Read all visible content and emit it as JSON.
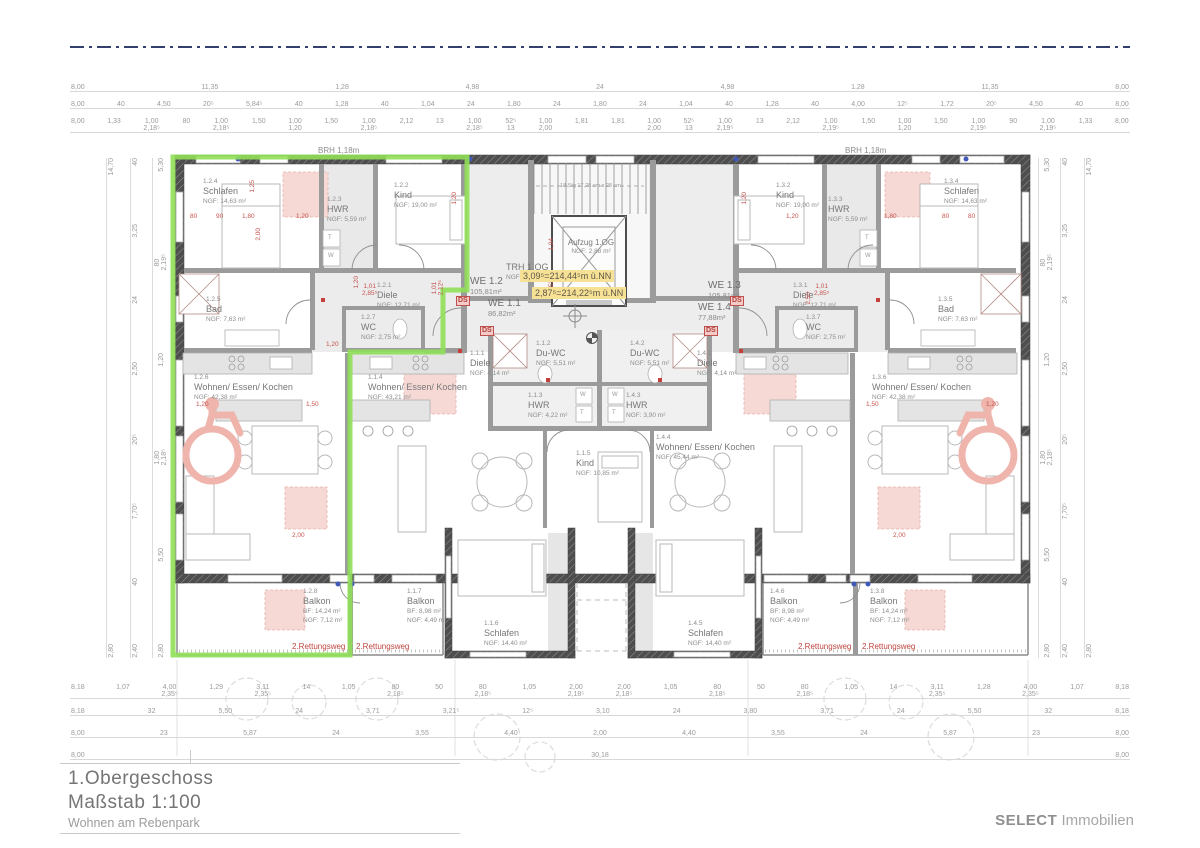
{
  "title_block": {
    "floor": "1.Obergeschoss",
    "scale": "Maßstab 1:100",
    "project": "Wohnen am Rebenpark"
  },
  "branding": {
    "company": "SELECT",
    "suffix": " Immobilien"
  },
  "core": {
    "trh_name": "TRH 1.OG",
    "trh_area": "NGF: 19,63 m²",
    "lift_name": "Aufzug 1.OG",
    "lift_area": "NGF: 2,88 m²",
    "stair_note": "18 Stg 17,28 cm x 28 cm",
    "elev_upper": "3,09⁵=214,44⁵m ü.NN",
    "elev_lower": "2,87⁵=214,22⁵m ü.NN"
  },
  "labels": {
    "brh": "BRH 1,18m",
    "ds": "DS",
    "escape": "2.Rettungsweg",
    "w": "W",
    "t": "T"
  },
  "units": {
    "we11": {
      "label": "WE 1.1",
      "area": "86,82m²"
    },
    "we12": {
      "label": "WE 1.2",
      "area": "105,81m²"
    },
    "we13": {
      "label": "WE 1.3",
      "area": "105,81m²"
    },
    "we14": {
      "label": "WE 1.4",
      "area": "77,88m²"
    }
  },
  "rooms": {
    "r124": {
      "id": "1.2.4",
      "name": "Schlafen",
      "area": "NGF: 14,63 m²"
    },
    "r123": {
      "id": "1.2.3",
      "name": "HWR",
      "area": "NGF: 5,59 m²"
    },
    "r122": {
      "id": "1.2.2",
      "name": "Kind",
      "area": "NGF: 19,00 m²"
    },
    "r121": {
      "id": "1.2.1",
      "name": "Diele",
      "area": "NGF: 12,71 m²"
    },
    "r125": {
      "id": "1.2.5",
      "name": "Bad",
      "area": "NGF: 7,63 m²"
    },
    "r127": {
      "id": "1.2.7",
      "name": "WC",
      "area": "NGF: 2,75 m²"
    },
    "r126": {
      "id": "1.2.6",
      "name": "Wohnen/ Essen/ Kochen",
      "area": "NGF: 42,38 m²"
    },
    "r128": {
      "id": "1.2.8",
      "name": "Balkon",
      "bf": "BF: 14,24 m²",
      "ngf": "NGF: 7,12 m²"
    },
    "r111": {
      "id": "1.1.1",
      "name": "Diele",
      "area": "NGF: 4,14 m²"
    },
    "r112": {
      "id": "1.1.2",
      "name": "Du-WC",
      "area": "NGF: 5,51 m²"
    },
    "r113": {
      "id": "1.1.3",
      "name": "HWR",
      "area": "NGF: 4,22 m²"
    },
    "r114": {
      "id": "1.1.4",
      "name": "Wohnen/ Essen/ Kochen",
      "area": "NGF: 43,21 m²"
    },
    "r115": {
      "id": "1.1.5",
      "name": "Kind",
      "area": "NGF: 10,85 m²"
    },
    "r116": {
      "id": "1.1.6",
      "name": "Schlafen",
      "area": "NGF: 14,40 m²"
    },
    "r117": {
      "id": "1.1.7",
      "name": "Balkon",
      "bf": "BF: 8,98 m²",
      "ngf": "NGF: 4,49 m²"
    },
    "r141": {
      "id": "1.4.1",
      "name": "Diele",
      "area": "NGF: 4,14 m²"
    },
    "r142": {
      "id": "1.4.2",
      "name": "Du-WC",
      "area": "NGF: 5,51 m²"
    },
    "r143": {
      "id": "1.4.3",
      "name": "HWR",
      "area": "NGF: 3,90 m²"
    },
    "r144": {
      "id": "1.4.4",
      "name": "Wohnen/ Essen/ Kochen",
      "area": "NGF: 45,44 m²"
    },
    "r145": {
      "id": "1.4.5",
      "name": "Schlafen",
      "area": "NGF: 14,40 m²"
    },
    "r146": {
      "id": "1.4.6",
      "name": "Balkon",
      "bf": "BF: 8,98 m²",
      "ngf": "NGF: 4,49 m²"
    },
    "r131": {
      "id": "1.3.1",
      "name": "Diele",
      "area": "NGF: 12,71 m²"
    },
    "r132": {
      "id": "1.3.2",
      "name": "Kind",
      "area": "NGF: 19,00 m²"
    },
    "r133": {
      "id": "1.3.3",
      "name": "HWR",
      "area": "NGF: 5,59 m²"
    },
    "r134": {
      "id": "1.3.4",
      "name": "Schlafen",
      "area": "NGF: 14,63 m²"
    },
    "r135": {
      "id": "1.3.5",
      "name": "Bad",
      "area": "NGF: 7,63 m²"
    },
    "r137": {
      "id": "1.3.7",
      "name": "WC",
      "area": "NGF: 2,75 m²"
    },
    "r136": {
      "id": "1.3.6",
      "name": "Wohnen/ Essen/ Kochen",
      "area": "NGF: 42,38 m²"
    },
    "r138": {
      "id": "1.3.8",
      "name": "Balkon",
      "bf": "BF: 14,24 m²",
      "ngf": "NGF: 7,12 m²"
    }
  },
  "dims": {
    "top1": [
      "8,00",
      "11,35",
      "1,28",
      "4,98",
      "24",
      "4,98",
      "1,28",
      "11,35",
      "8,00"
    ],
    "top2": [
      "8,00",
      "40",
      "4,50",
      "20⁵",
      "5,84⁵",
      "40",
      "1,28",
      "40",
      "1,04",
      "24",
      "1,80",
      "24",
      "1,80",
      "24",
      "1,04",
      "40",
      "1,28",
      "40",
      "4,00",
      "12⁵",
      "1,72",
      "20⁵",
      "4,50",
      "40",
      "8,00"
    ],
    "top3": [
      "8,00",
      "1,33",
      "1,00\n2,18⁵",
      "80",
      "1,00\n2,18⁵",
      "1,50",
      "1,00\n1,20",
      "1,50",
      "1,00\n2,18⁵",
      "2,12",
      "13",
      "1,00\n2,18⁵",
      "52⁵\n13",
      "1,00\n2,00",
      "1,81",
      "1,81",
      "1,00\n2,00",
      "52⁵\n13",
      "1,00\n2,19⁵",
      "13",
      "2,12",
      "1,00\n2,19⁵",
      "1,50",
      "1,00\n1,20",
      "1,50",
      "1,00\n2,19⁵",
      "90",
      "1,00\n2,19⁵",
      "1,33",
      "8,00"
    ],
    "bottom1": [
      "8,18",
      "1,07",
      "4,00\n2,35⁵",
      "1,29",
      "3,11\n2,35⁵",
      "14",
      "1,05",
      "80\n2,18⁵",
      "50",
      "80\n2,18⁵",
      "1,05",
      "2,00\n2,18⁵",
      "2,00\n2,18⁵",
      "1,05",
      "80\n2,18⁵",
      "50",
      "80\n2,18⁵",
      "1,05",
      "14",
      "3,11\n2,35⁵",
      "1,28",
      "4,00\n2,35⁵",
      "1,07",
      "8,18"
    ],
    "bottom2": [
      "8,18",
      "32",
      "5,50",
      "24",
      "3,71",
      "3,21⁵",
      "12⁵",
      "3,10",
      "24",
      "3,80",
      "3,71",
      "24",
      "5,50",
      "32",
      "8,18"
    ],
    "bottom3": [
      "8,00",
      "23",
      "5,87",
      "24",
      "3,55",
      "4,40",
      "2,00",
      "4,40",
      "3,55",
      "24",
      "5,87",
      "23",
      "8,00"
    ],
    "bottom4": [
      "8,00",
      "30,18",
      "8,00"
    ],
    "left1": [
      "14,70",
      "2,80"
    ],
    "left2": [
      "40",
      "3,25",
      "24",
      "2,50",
      "20⁵",
      "7,70⁵",
      "40",
      "2,40"
    ],
    "left3": [
      "5,30",
      "80\n2,19⁵",
      "1,20",
      "1,80\n2,18⁵",
      "5,50",
      "2,80"
    ],
    "right1": [
      "5,30",
      "80\n2,19⁵",
      "1,20",
      "1,80\n2,18⁵",
      "5,50",
      "2,80"
    ],
    "right2": [
      "40",
      "3,25",
      "24",
      "2,50",
      "20⁵",
      "7,70⁵",
      "40",
      "2,40"
    ],
    "right3": [
      "14,70",
      "2,80"
    ],
    "red": [
      "80",
      "90",
      "1,80",
      "1,20",
      "1,20",
      "1,80",
      "80",
      "80",
      "1,25",
      "2,00",
      "1,20",
      "1,01\n2,85⁵",
      "1,01\n2,12⁵",
      "1,20",
      "1,20",
      "1,04",
      "1,53",
      "1,20",
      "1,20",
      "1,50",
      "1,50",
      "1,20",
      "2,00",
      "2,00",
      "2,50",
      "1,01\n2,85⁵"
    ]
  }
}
